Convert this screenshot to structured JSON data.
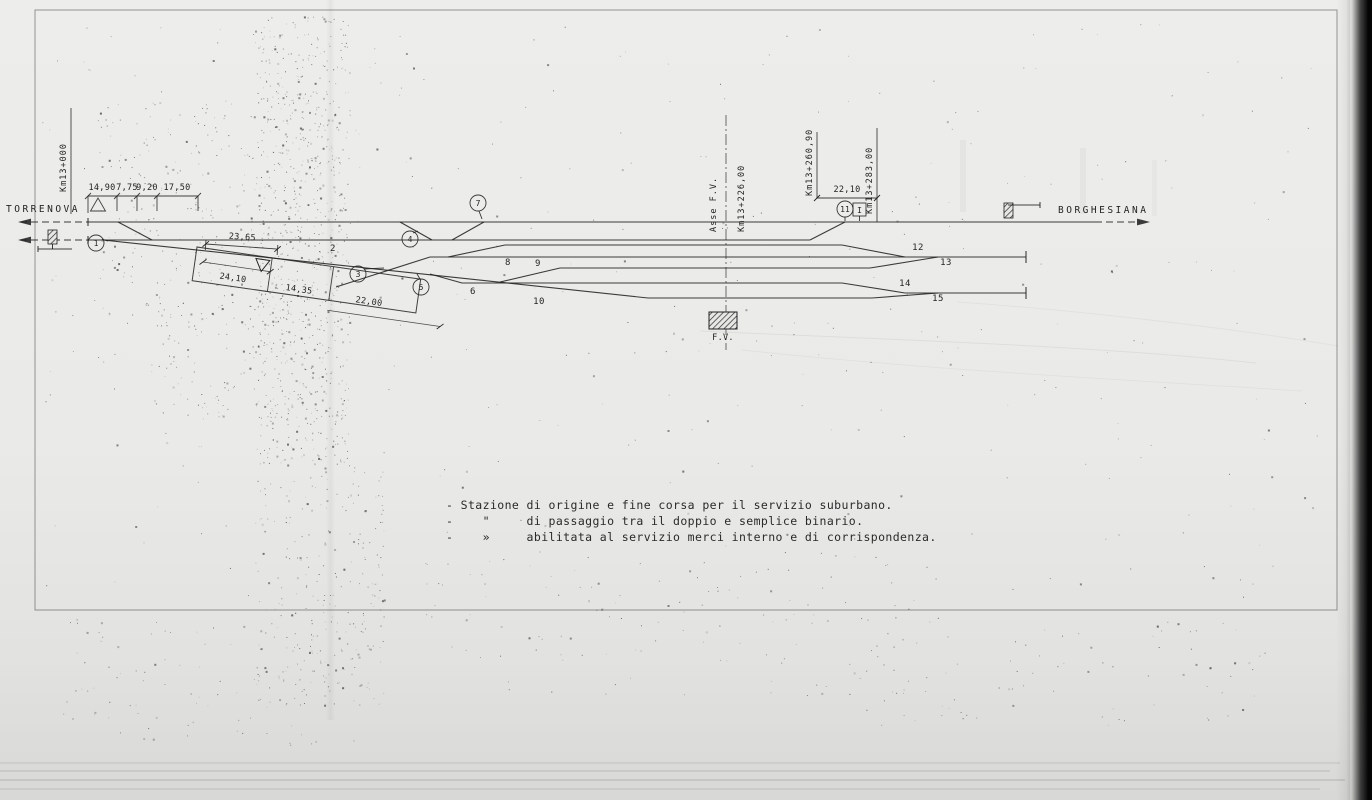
{
  "stations": {
    "left": "TORRENOVA",
    "right": "BORGHESIANA"
  },
  "km_markers": {
    "origin": "Km13+000",
    "axis_title": "Asse  F.V.",
    "axis": "Km13+226,00",
    "k260": "Km13+260,90",
    "k283": "Km13+283,00"
  },
  "dimensions": {
    "block": [
      "14,90",
      "7,75",
      "9,20",
      "17,50"
    ],
    "lead": "23,65",
    "platform": [
      "24,10",
      "14,35",
      "22,00"
    ],
    "right": "22,10"
  },
  "switches": {
    "s1": "1",
    "s3": "3",
    "s4": "4",
    "s5": "5",
    "s7": "7",
    "s11": "11",
    "boxed_signal": "I"
  },
  "tracks": {
    "t2": "2",
    "t6": "6",
    "t8": "8",
    "t9": "9",
    "t10": "10",
    "t12": "12",
    "t13": "13",
    "t14": "14",
    "t15": "15"
  },
  "building": {
    "label": "F.V."
  },
  "notes": [
    "- Stazione di origine e fine corsa per il servizio suburbano.",
    "-    \"     di passaggio tra il doppio e semplice binario.",
    "-    »     abilitata al servizio merci interno e di corrispondenza."
  ],
  "colors": {
    "ink": "#222222",
    "paper": "#ebebe9",
    "page_edge": "#0a0a0a"
  }
}
